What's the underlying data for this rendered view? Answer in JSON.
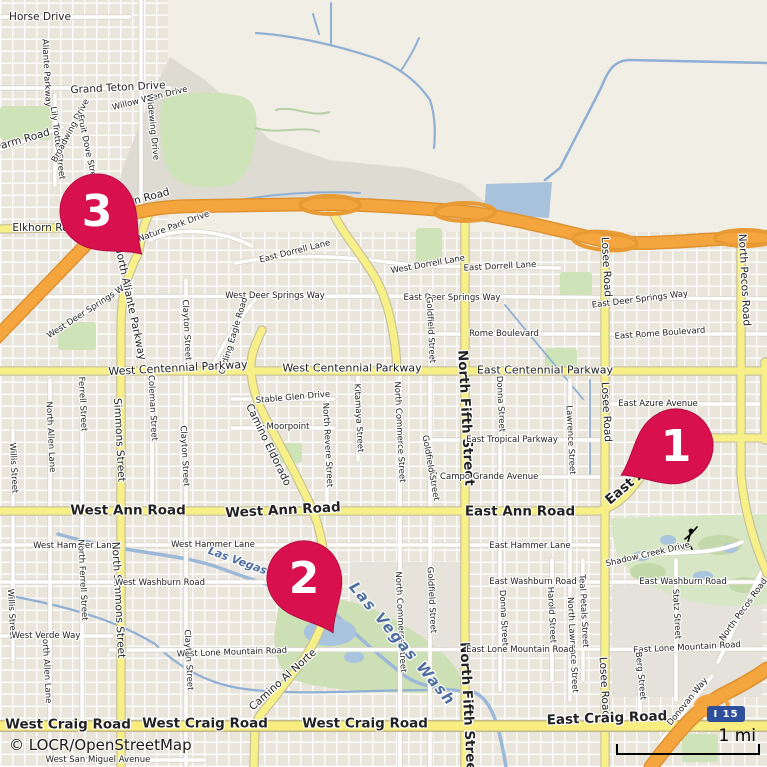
{
  "map": {
    "attribution": "© LOCR/OpenStreetMap",
    "scale_bar": {
      "label": "1 mi"
    },
    "shield": {
      "label": "I 15"
    },
    "colors": {
      "marker": "#d8104e",
      "marker_edge": "#b50d47",
      "motorway_orange": "#f5a53d",
      "road_yellow": "#f7f089",
      "water_blue": "#9db9d8",
      "park_green": "#cfe3b8",
      "water_label_blue": "#4d6e9e",
      "shield_blue": "#2f4f9b"
    },
    "markers": [
      {
        "number": "1",
        "x": 676,
        "y": 446,
        "rot": 62
      },
      {
        "number": "2",
        "x": 304,
        "y": 578,
        "rot": -28
      },
      {
        "number": "3",
        "x": 97,
        "y": 211,
        "rot": -46
      }
    ],
    "labels": [
      {
        "text": "Horse Drive",
        "x": 40,
        "y": 17,
        "rot": 0,
        "cls": "md"
      },
      {
        "text": "Grand Teton Drive",
        "x": 118,
        "y": 88,
        "rot": -3,
        "cls": "md"
      },
      {
        "text": "Willow Wren Drive",
        "x": 150,
        "y": 99,
        "rot": -14,
        "cls": "sm"
      },
      {
        "text": "Aliante Parkway",
        "x": 46,
        "y": 73,
        "rot": 87,
        "cls": "sm"
      },
      {
        "text": "Lily Trotter Street",
        "x": 57,
        "y": 143,
        "rot": 83,
        "cls": "sm"
      },
      {
        "text": "Broadwing Drive",
        "x": 71,
        "y": 131,
        "rot": -62,
        "cls": "sm"
      },
      {
        "text": "Fruit Dove Street",
        "x": 87,
        "y": 150,
        "rot": 78,
        "cls": "sm"
      },
      {
        "text": "Widewing Drive",
        "x": 152,
        "y": 127,
        "rot": 84,
        "cls": "sm"
      },
      {
        "text": "Farm Road",
        "x": 23,
        "y": 140,
        "rot": -16,
        "cls": "md"
      },
      {
        "text": "Elkhorn Road",
        "x": 47,
        "y": 228,
        "rot": 0,
        "cls": "md"
      },
      {
        "text": "Elkhorn Road",
        "x": 136,
        "y": 201,
        "rot": -15,
        "cls": "md"
      },
      {
        "text": "Nature Park Drive",
        "x": 174,
        "y": 227,
        "rot": -20,
        "cls": "sm"
      },
      {
        "text": "East Dorrell Lane",
        "x": 295,
        "y": 252,
        "rot": -14,
        "cls": "sm"
      },
      {
        "text": "West Dorrell Lane",
        "x": 428,
        "y": 265,
        "rot": -10,
        "cls": "sm"
      },
      {
        "text": "East Dorrell Lane",
        "x": 500,
        "y": 267,
        "rot": -3,
        "cls": "sm"
      },
      {
        "text": "West Deer Springs Way",
        "x": 90,
        "y": 310,
        "rot": -33,
        "cls": "sm"
      },
      {
        "text": "West Deer Springs Way",
        "x": 275,
        "y": 296,
        "rot": 0,
        "cls": "sm"
      },
      {
        "text": "East Deer Springs Way",
        "x": 452,
        "y": 298,
        "rot": 0,
        "cls": "sm"
      },
      {
        "text": "East Deer Springs Way",
        "x": 640,
        "y": 300,
        "rot": -7,
        "cls": "sm"
      },
      {
        "text": "Rome Boulevard",
        "x": 504,
        "y": 334,
        "rot": 0,
        "cls": "sm"
      },
      {
        "text": "East Rome Boulevard",
        "x": 660,
        "y": 334,
        "rot": -4,
        "cls": "sm"
      },
      {
        "text": "North Aliante Parkway",
        "x": 130,
        "y": 303,
        "rot": 78,
        "cls": "md"
      },
      {
        "text": "Clayton Street",
        "x": 186,
        "y": 330,
        "rot": 87,
        "cls": "sm"
      },
      {
        "text": "Gliding Eagle Road",
        "x": 234,
        "y": 336,
        "rot": -73,
        "cls": "sm"
      },
      {
        "text": "Goldfield Street",
        "x": 430,
        "y": 330,
        "rot": 87,
        "cls": "sm"
      },
      {
        "text": "West Centennial Parkway",
        "x": 178,
        "y": 368,
        "rot": -3,
        "cls": "md11"
      },
      {
        "text": "West Centennial Parkway",
        "x": 352,
        "y": 368,
        "rot": 0,
        "cls": "md11"
      },
      {
        "text": "East Centennial Parkway",
        "x": 545,
        "y": 370,
        "rot": 0,
        "cls": "md11"
      },
      {
        "text": "North Fifth Street",
        "x": 465,
        "y": 418,
        "rot": 87,
        "cls": "lg"
      },
      {
        "text": "North Fifth Street",
        "x": 467,
        "y": 710,
        "rot": 87,
        "cls": "lg"
      },
      {
        "text": "Donna Street",
        "x": 500,
        "y": 404,
        "rot": 87,
        "cls": "sm"
      },
      {
        "text": "Donna Street",
        "x": 503,
        "y": 618,
        "rot": 87,
        "cls": "sm"
      },
      {
        "text": "Lawrence Street",
        "x": 570,
        "y": 440,
        "rot": 87,
        "cls": "sm"
      },
      {
        "text": "North Lawrence Street",
        "x": 572,
        "y": 645,
        "rot": 87,
        "cls": "sm"
      },
      {
        "text": "Losee Road",
        "x": 606,
        "y": 267,
        "rot": 87,
        "cls": "md"
      },
      {
        "text": "Losee Road",
        "x": 606,
        "y": 412,
        "rot": 87,
        "cls": "md"
      },
      {
        "text": "Losee Road",
        "x": 604,
        "y": 687,
        "rot": 87,
        "cls": "md"
      },
      {
        "text": "North Pecos Road",
        "x": 744,
        "y": 280,
        "rot": 87,
        "cls": "md"
      },
      {
        "text": "East Azure Avenue",
        "x": 658,
        "y": 404,
        "rot": 0,
        "cls": "sm"
      },
      {
        "text": "East Tropical Parkway",
        "x": 512,
        "y": 440,
        "rot": 0,
        "cls": "sm"
      },
      {
        "text": "El Campo Grande Avenue",
        "x": 484,
        "y": 477,
        "rot": 0,
        "cls": "sm"
      },
      {
        "text": "Stable Glen Drive",
        "x": 293,
        "y": 398,
        "rot": -5,
        "cls": "sm"
      },
      {
        "text": "Moorpoint",
        "x": 288,
        "y": 427,
        "rot": 0,
        "cls": "sm"
      },
      {
        "text": "Camino Eldorado",
        "x": 268,
        "y": 445,
        "rot": 64,
        "cls": "md"
      },
      {
        "text": "North Revere Street",
        "x": 327,
        "y": 445,
        "rot": 87,
        "cls": "sm"
      },
      {
        "text": "Kitamaya Street",
        "x": 358,
        "y": 418,
        "rot": 87,
        "cls": "sm"
      },
      {
        "text": "North Commerce Street",
        "x": 399,
        "y": 432,
        "rot": 87,
        "cls": "sm"
      },
      {
        "text": "North Commerce Street",
        "x": 400,
        "y": 622,
        "rot": 87,
        "cls": "sm"
      },
      {
        "text": "Goldfield Street",
        "x": 430,
        "y": 468,
        "rot": 80,
        "cls": "sm"
      },
      {
        "text": "Goldfield Street",
        "x": 431,
        "y": 600,
        "rot": 87,
        "cls": "sm"
      },
      {
        "text": "West Ann Road",
        "x": 128,
        "y": 511,
        "rot": 0,
        "cls": "lg"
      },
      {
        "text": "West Ann Road",
        "x": 283,
        "y": 511,
        "rot": -3,
        "cls": "lg"
      },
      {
        "text": "East Ann Road",
        "x": 520,
        "y": 512,
        "rot": 0,
        "cls": "lg"
      },
      {
        "text": "East Ann Road",
        "x": 650,
        "y": 467,
        "rot": -40,
        "cls": "lg"
      },
      {
        "text": "West Hammer Lane",
        "x": 75,
        "y": 546,
        "rot": 0,
        "cls": "sm"
      },
      {
        "text": "West Hammer Lane",
        "x": 213,
        "y": 545,
        "rot": 0,
        "cls": "sm"
      },
      {
        "text": "East Hammer Lane",
        "x": 530,
        "y": 546,
        "rot": 0,
        "cls": "sm"
      },
      {
        "text": "Simmons Street",
        "x": 119,
        "y": 440,
        "rot": 87,
        "cls": "md"
      },
      {
        "text": "North Simmons Street",
        "x": 118,
        "y": 600,
        "rot": 87,
        "cls": "md"
      },
      {
        "text": "Ferrell Street",
        "x": 82,
        "y": 404,
        "rot": 87,
        "cls": "sm"
      },
      {
        "text": "North Ferrell Street",
        "x": 82,
        "y": 580,
        "rot": 87,
        "cls": "sm"
      },
      {
        "text": "Coleman Street",
        "x": 152,
        "y": 408,
        "rot": 87,
        "cls": "sm"
      },
      {
        "text": "Clayton Street",
        "x": 184,
        "y": 456,
        "rot": 87,
        "cls": "sm"
      },
      {
        "text": "Clayton Street",
        "x": 188,
        "y": 660,
        "rot": 87,
        "cls": "sm"
      },
      {
        "text": "North Allen Lane",
        "x": 50,
        "y": 437,
        "rot": 87,
        "cls": "sm"
      },
      {
        "text": "North Allen Lane",
        "x": 46,
        "y": 668,
        "rot": 87,
        "cls": "sm"
      },
      {
        "text": "Willis Street",
        "x": 13,
        "y": 468,
        "rot": 87,
        "cls": "sm"
      },
      {
        "text": "Willis Street",
        "x": 11,
        "y": 614,
        "rot": 87,
        "cls": "sm"
      },
      {
        "text": "West Washburn Road",
        "x": 160,
        "y": 583,
        "rot": 0,
        "cls": "sm"
      },
      {
        "text": "East Washburn Road",
        "x": 533,
        "y": 582,
        "rot": 0,
        "cls": "sm"
      },
      {
        "text": "East Washburn Road",
        "x": 683,
        "y": 582,
        "rot": 0,
        "cls": "sm"
      },
      {
        "text": "West Verde Way",
        "x": 46,
        "y": 636,
        "rot": 0,
        "cls": "sm"
      },
      {
        "text": "West Lone Mountain Road",
        "x": 232,
        "y": 653,
        "rot": -2,
        "cls": "sm"
      },
      {
        "text": "East Lone Mountain Road",
        "x": 520,
        "y": 650,
        "rot": 0,
        "cls": "sm"
      },
      {
        "text": "East Lone Mountain Road",
        "x": 687,
        "y": 648,
        "rot": -3,
        "cls": "sm"
      },
      {
        "text": "Harold Street",
        "x": 551,
        "y": 615,
        "rot": 87,
        "cls": "sm"
      },
      {
        "text": "Teal Petals Street",
        "x": 583,
        "y": 611,
        "rot": 87,
        "cls": "sm"
      },
      {
        "text": "Statz Street",
        "x": 676,
        "y": 614,
        "rot": 87,
        "cls": "sm"
      },
      {
        "text": "Berg Street",
        "x": 640,
        "y": 676,
        "rot": 84,
        "cls": "sm"
      },
      {
        "text": "Camino Al Norte",
        "x": 283,
        "y": 680,
        "rot": -42,
        "cls": "md"
      },
      {
        "text": "Shadow Creek Drive",
        "x": 648,
        "y": 555,
        "rot": -13,
        "cls": "sm"
      },
      {
        "text": "Donovan Way",
        "x": 688,
        "y": 702,
        "rot": -51,
        "cls": "sm"
      },
      {
        "text": "North Pecos Road",
        "x": 744,
        "y": 610,
        "rot": -54,
        "cls": "sm"
      },
      {
        "text": "West San Miguel Avenue",
        "x": 98,
        "y": 760,
        "rot": 0,
        "cls": "sm"
      },
      {
        "text": "West Craig Road",
        "x": 68,
        "y": 725,
        "rot": 0,
        "cls": "lg"
      },
      {
        "text": "West Craig Road",
        "x": 205,
        "y": 724,
        "rot": 0,
        "cls": "lg"
      },
      {
        "text": "West Craig Road",
        "x": 365,
        "y": 724,
        "rot": 0,
        "cls": "lg"
      },
      {
        "text": "East Craig Road",
        "x": 607,
        "y": 719,
        "rot": -2,
        "cls": "lg"
      },
      {
        "text": "Las Vegas Wash",
        "x": 255,
        "y": 567,
        "rot": 20,
        "cls": "water"
      },
      {
        "text": "Las Vegas Wash",
        "x": 402,
        "y": 644,
        "rot": 50,
        "cls": "waterlg"
      }
    ]
  }
}
